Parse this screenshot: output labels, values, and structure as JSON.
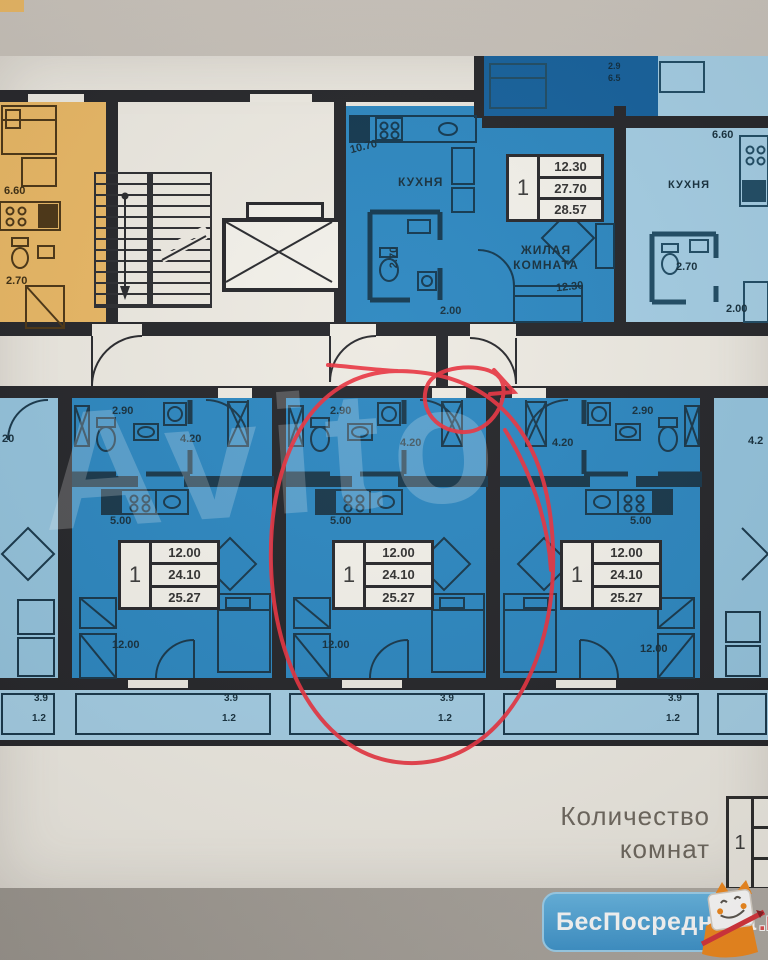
{
  "watermark": {
    "text": "Avito"
  },
  "legend": {
    "line1": "Количество",
    "line2": "комнат",
    "rooms": "1"
  },
  "logo": {
    "brand": "БесПосредника",
    "tld": ".ru"
  },
  "annotation_color": "#e8323f",
  "top_left_unit": {
    "area": "6.60",
    "wc": "2.70"
  },
  "top_mid_unit": {
    "dim": "10.70",
    "kitchen": "КУХНЯ",
    "wc": "2.70",
    "hall": "2.00",
    "living_line1": "ЖИЛАЯ",
    "living_line2": "КОМНАТА",
    "living_area": "12.30",
    "info": {
      "rooms": "1",
      "row1": "12.30",
      "row2": "27.70",
      "row3": "28.57"
    }
  },
  "top_right_unit": {
    "area": "6.60",
    "kitchen": "КУХНЯ",
    "wc": "2.70",
    "hall": "2.00"
  },
  "loggia": {
    "dim1": "2.9",
    "dim2": "6.5"
  },
  "units": [
    {
      "wc": "2.90",
      "hall": "4.20",
      "kitchen": "5.00",
      "living": "12.00",
      "balcony1": "3.9",
      "balcony2": "1.2",
      "info": {
        "rooms": "1",
        "row1": "12.00",
        "row2": "24.10",
        "row3": "25.27"
      }
    },
    {
      "wc": "2.90",
      "hall": "4.20",
      "kitchen": "5.00",
      "living": "12.00",
      "balcony1": "3.9",
      "balcony2": "1.2",
      "info": {
        "rooms": "1",
        "row1": "12.00",
        "row2": "24.10",
        "row3": "25.27"
      }
    },
    {
      "wc": "2.90",
      "hall": "4.20",
      "kitchen": "5.00",
      "living": "12.00",
      "balcony1": "3.9",
      "balcony2": "1.2",
      "info": {
        "rooms": "1",
        "row1": "12.00",
        "row2": "24.10",
        "row3": "25.27"
      }
    }
  ],
  "partial_left": {
    "dim": "20",
    "balcony1": "3.9",
    "balcony2": "1.2"
  },
  "partial_right": {
    "dim": "4.2"
  }
}
